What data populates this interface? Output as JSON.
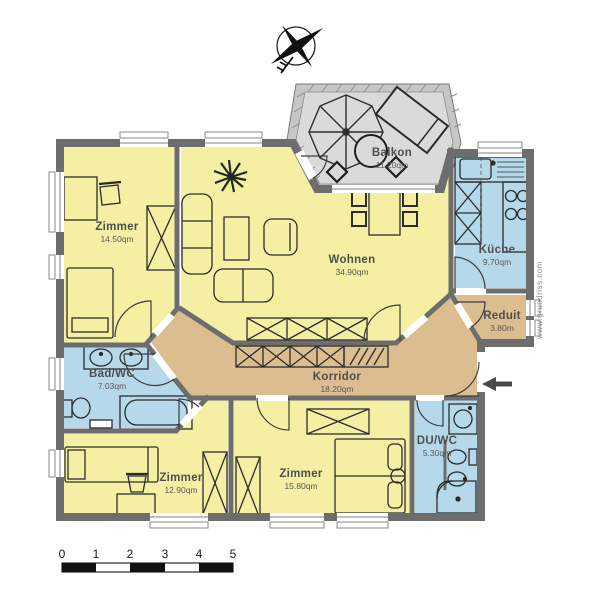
{
  "plan": {
    "rooms": [
      {
        "name": "Balkon",
        "area": "11.20qm"
      },
      {
        "name": "Zimmer",
        "area": "14.50qm"
      },
      {
        "name": "Wohnen",
        "area": "34.90qm"
      },
      {
        "name": "Küche",
        "area": "9.70qm"
      },
      {
        "name": "Reduit",
        "area": "3.80m"
      },
      {
        "name": "Bad/WC",
        "area": "7.03qm"
      },
      {
        "name": "Korridor",
        "area": "18.20qm"
      },
      {
        "name": "Zimmer",
        "area": "12.90qm"
      },
      {
        "name": "Zimmer",
        "area": "15.80qm"
      },
      {
        "name": "DU/WC",
        "area": "5.30qm"
      }
    ],
    "scale": {
      "labels": [
        "0",
        "1",
        "2",
        "3",
        "4",
        "5"
      ]
    },
    "watermark": "www.grundriss.com",
    "colors": {
      "room_yellow": "#f4efa3",
      "room_blue": "#b5d9ea",
      "room_tan": "#dcbd90",
      "balcony_floor": "#dadada",
      "balcony_wall": "#c6c6c6",
      "wall_gray": "#6d6d6d"
    }
  }
}
